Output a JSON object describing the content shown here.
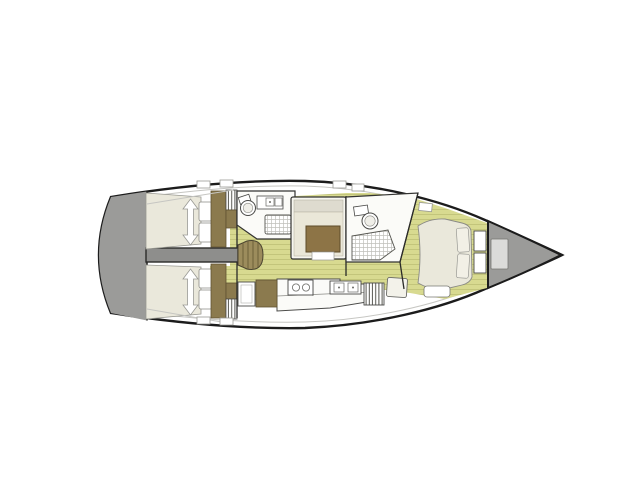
{
  "diagram": {
    "type": "sailboat-interior-deck-plan",
    "orientation": "bow-right",
    "areas": [
      "swim platform",
      "aft cabin port",
      "aft cabin starboard",
      "engine compartment",
      "companionway steps",
      "aft head",
      "saloon",
      "galley",
      "chart table seat",
      "forward head",
      "forward cabin",
      "anchor locker"
    ],
    "fixtures": [
      "double berth",
      "pillows",
      "berth arrow",
      "wardrobe",
      "louver locker",
      "toilet",
      "sink",
      "shower grate",
      "saloon table",
      "settee",
      "stove",
      "galley sink",
      "fridge",
      "nav desk",
      "island berth",
      "bow shelves",
      "deck hatch",
      "anchor hatch"
    ]
  },
  "colors": {
    "background": "#ffffff",
    "hull_outline": "#1c1c1c",
    "deck_line": "#c6c6c2",
    "transom_gray": "#9b9b99",
    "bow_hatch": "#dbdbd9",
    "engine_box": "#8e8e8c",
    "steps_wood": "#9c8c5c",
    "step_line": "#6d5f38",
    "floor_base": "#d8da90",
    "floor_plank": "#c3c57b",
    "cabinet_brown": "#8b7a4e",
    "table_brown": "#8d7446",
    "mattress_cream": "#eae8db",
    "cushion_cream": "#eae7d8",
    "backrest_gray": "#dedbcf",
    "fixture_white": "#fbfbf8",
    "fixture_stroke": "#4a4a48",
    "wall_line": "#2a2a28",
    "louver_line": "#55554f",
    "shower_grid": "#bfbfba",
    "soft_stroke": "#9a9a93"
  }
}
